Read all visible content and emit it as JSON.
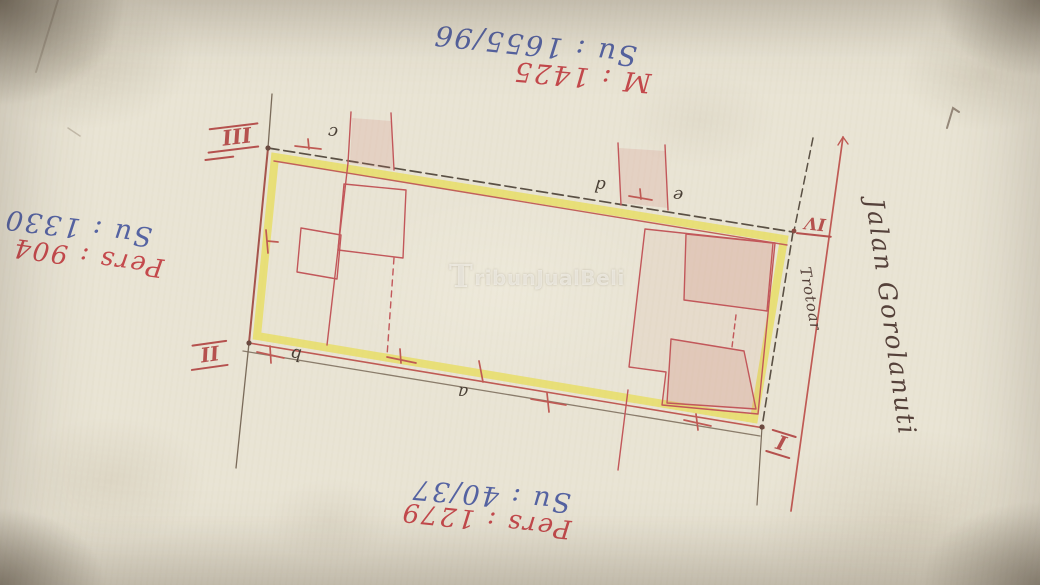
{
  "document": {
    "type": "hand-drawn land survey site sketch (photo)",
    "watermark": {
      "initial": "T",
      "rest": "ribunJualBeli"
    }
  },
  "annotations": {
    "top_blue": "Su : 1655/96",
    "top_red": "M : 1425",
    "left_blue": "Su : 1330",
    "left_red": "Pers : 904",
    "bottom_blue": "Su : 40/37",
    "bottom_red": "Pers : 1279",
    "street": "Jalan Gorolanuti",
    "sidewalk": "Trotoar"
  },
  "corner_numerals": {
    "i": "I",
    "ii": "II",
    "iii": "III",
    "iv": "IV"
  },
  "point_labels": {
    "a": "a",
    "b": "b",
    "c": "c",
    "d": "d",
    "e": "e"
  },
  "colors": {
    "paper": "#e9e4d4",
    "highlight_yellow": "#e7dd55",
    "ink_red_line": "#c2575a",
    "ink_red_text": "#c4494c",
    "ink_blue_text": "#5563a2",
    "pencil_dark": "#5a5044",
    "watermark_white": "#fdfcf7"
  }
}
